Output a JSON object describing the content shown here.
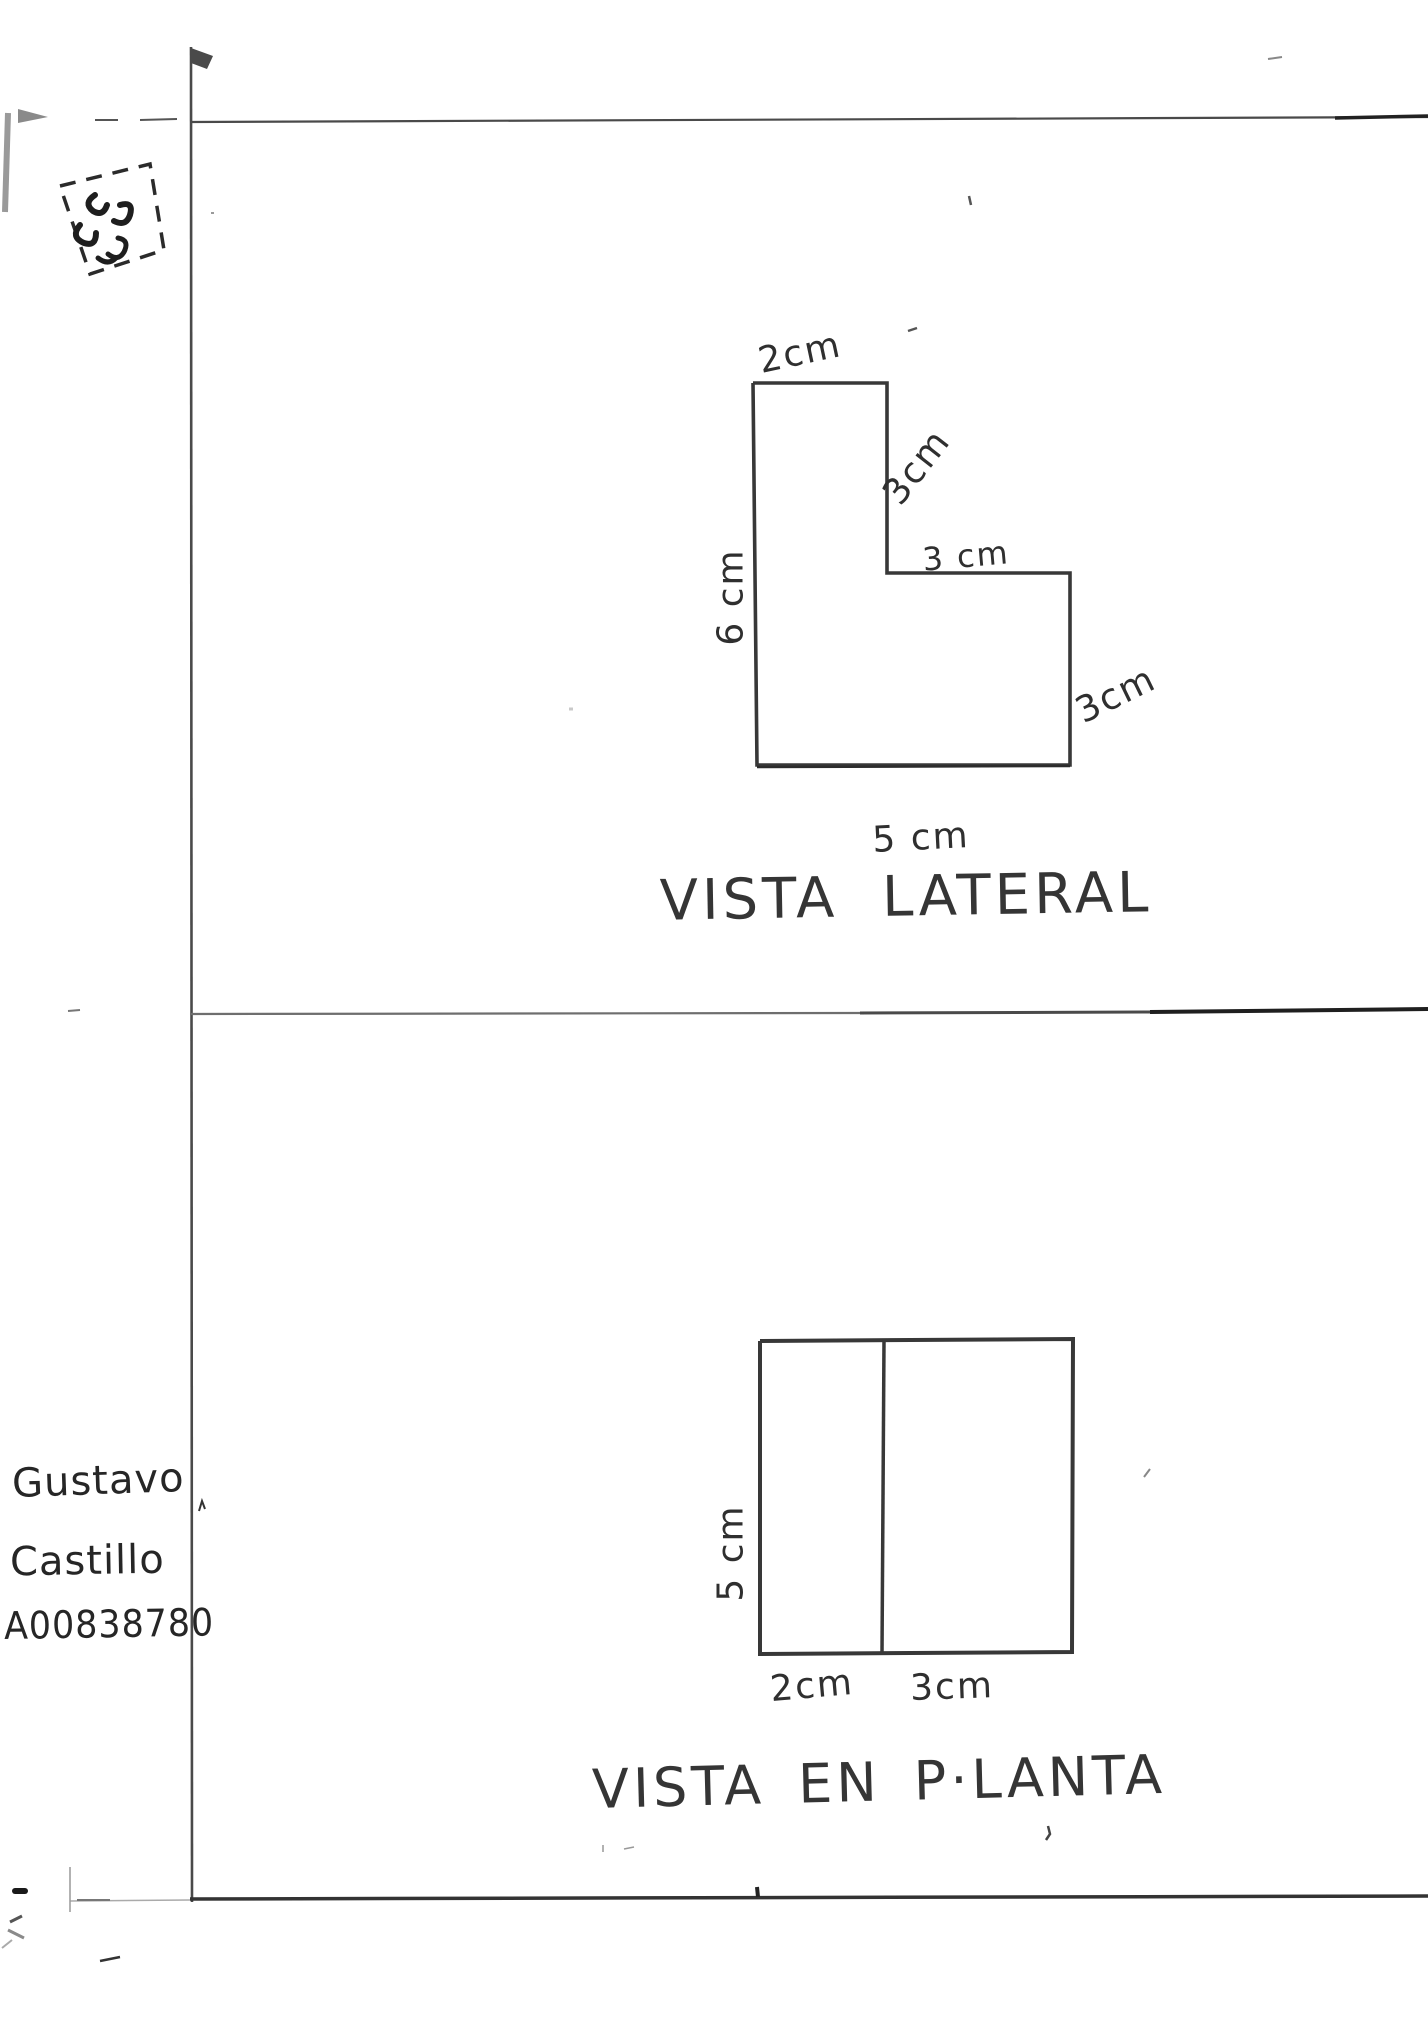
{
  "page": {
    "background": "#ffffff",
    "ink": "#3a3a3a"
  },
  "side_view": {
    "title": "VISTA LATERAL",
    "outline_points": "753,383 887,383 887,573 1070,573 1070,765 757,765 753,383",
    "bottom_edge_points": "757,767 1070,766",
    "labels": {
      "top": "2cm",
      "right_upper": "3cm",
      "step": "3 cm",
      "right_lower": "3cm",
      "left": "6 cm",
      "bottom": "5 cm"
    }
  },
  "plan_view": {
    "title": "VISTA EN P·LANTA",
    "outline_points": "760,1341 1073,1339 1072,1652 760,1654 760,1341",
    "divider_points": "884,1341 882,1653",
    "labels": {
      "left": "5 cm",
      "bottom_left": "2cm",
      "bottom_right": "3cm"
    }
  },
  "signature": {
    "line1": "Gustavo",
    "line2": "Castillo",
    "line3": "A00838780"
  }
}
